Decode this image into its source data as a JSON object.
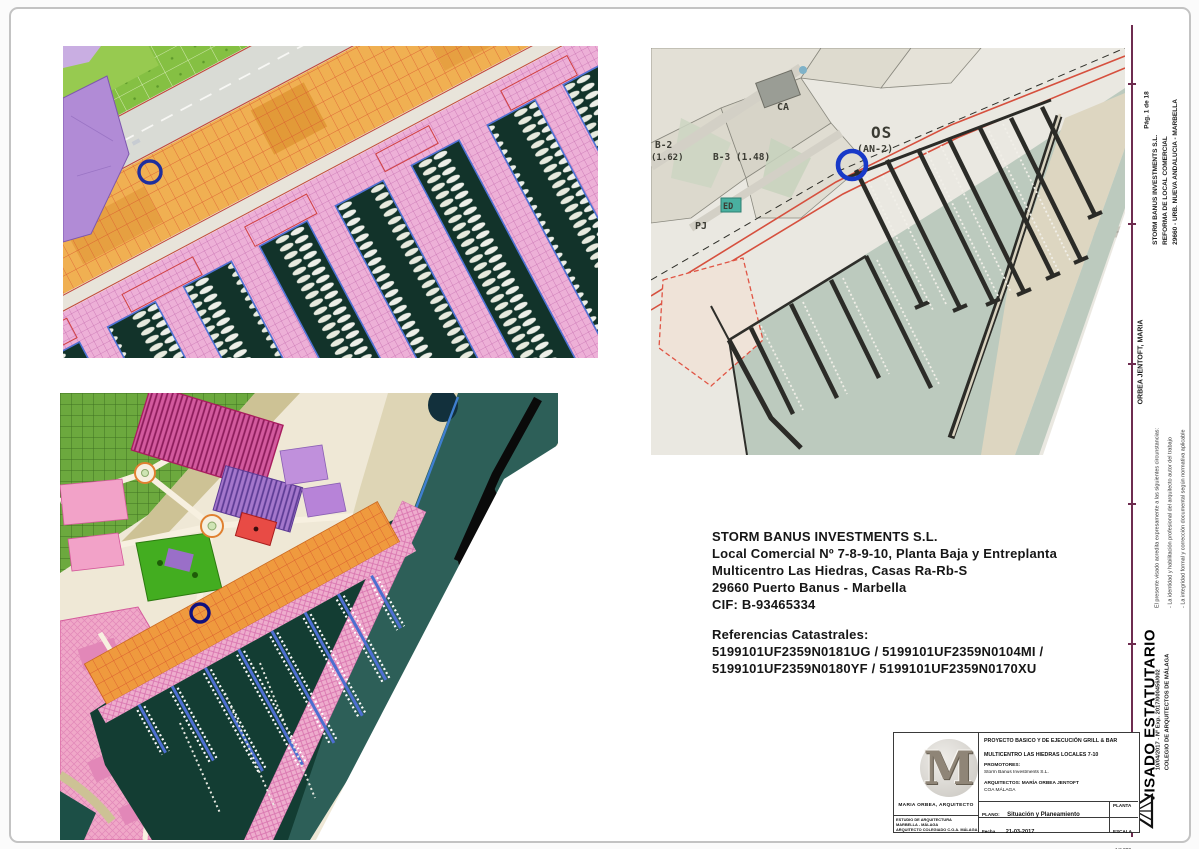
{
  "document": {
    "page_label": "Pág. 1 de 18"
  },
  "margin_column": {
    "project_lines": [
      "STORM BANUS INVESTMENTS S.L.",
      "REFORMA DE LOCAL COMERCIAL",
      "29660 - URB. NUEVA ANDALUCIA - MARBELLA"
    ],
    "architect": "ORBEA JENTOFT, MARIA",
    "visa_notes": [
      "El presente visado acredita expresamente a las siguientes circunstancias:",
      "- La identidad y habilitación profesional del arquitecto autor del trabajo",
      "- La integridad formal y corrección documental según normativa aplicable"
    ],
    "visa_stamp": {
      "title": "VISADO ESTATUTARIO",
      "file_ref": "10/04/2017 - Nº Exp. 2017/000456/002",
      "college": "COLEGIO DE ARQUITECTOS DE MÁLAGA"
    }
  },
  "owner_block": {
    "company": "STORM BANUS INVESTMENTS S.L.",
    "address1": "Local Comercial Nº 7-8-9-10, Planta Baja y Entreplanta",
    "address2": "Multicentro Las Hiedras, Casas Ra-Rb-S",
    "address3": "29660 Puerto Banus - Marbella",
    "cif": "CIF: B-93465334",
    "cadastral_heading": "Referencias Catastrales:",
    "cadastral_line1": "5199101UF2359N0181UG / 5199101UF2359N0104MI /",
    "cadastral_line2": "5199101UF2359N0180YF / 5199101UF2359N0170XU"
  },
  "title_block": {
    "logo_letter": "M",
    "logo_caption": "MARIA ORBEA, ARQUITECTO",
    "studio_lines": [
      "ESTUDIO DE ARQUITECTURA",
      "MARBELLA - MÁLAGA",
      "ARQUITECTO COLEGIADO C.O.A. MÁLAGA"
    ],
    "project_title": "PROYECTO BASICO Y DE EJECUCIÓN GRILL & BAR",
    "project_location": "MULTICENTRO LAS HIEDRAS LOCALES 7-10",
    "promoters_label": "PROMOTORES:",
    "promoters_value": "Storm Banus Investments S.L.",
    "architects_label": "ARQUITECTOS: MARÍA ORBEA JENTOFT",
    "architects_ref": "COA MÁLAGA",
    "plano_label": "PLANO:",
    "plano_value": "Situación y Planeamiento",
    "planta_label": "PLANTA",
    "fecha_label": "Fecha",
    "fecha_value": "21-03-2017",
    "escala_label": "ESCALA",
    "escala_value": "1:2.000"
  },
  "maps": {
    "plan_labels": {
      "ca": "CA",
      "b2": "B-2",
      "b2_val": "(1.62)",
      "b3": "B-3 (1.48)",
      "os": "OS",
      "os_zone": "(AN-2)",
      "ed": "ED",
      "pj": "PJ"
    }
  }
}
